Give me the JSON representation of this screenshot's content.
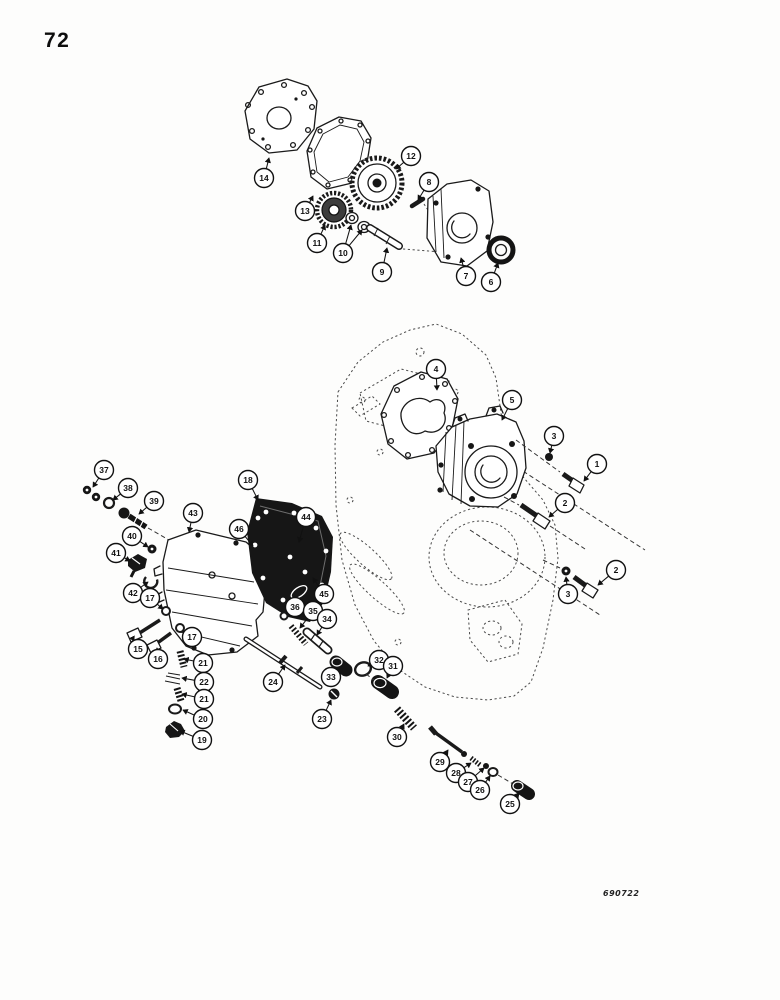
{
  "page": {
    "number": "72",
    "figure_code": "690722"
  },
  "diagram": {
    "description": "Exploded parts diagram: charging pump, transmission case and control valve assembly",
    "callouts": [
      {
        "label": "14",
        "cx": 264,
        "cy": 178,
        "tx": 269,
        "ty": 158
      },
      {
        "label": "13",
        "cx": 305,
        "cy": 211,
        "tx": 313,
        "ty": 196
      },
      {
        "label": "12",
        "cx": 411,
        "cy": 156,
        "tx": 396,
        "ty": 169
      },
      {
        "label": "11",
        "cx": 317,
        "cy": 243,
        "tx": 325,
        "ty": 225
      },
      {
        "label": "10",
        "cx": 343,
        "cy": 253,
        "tx": 351,
        "ty": 225,
        "tx2": 362,
        "ty2": 230
      },
      {
        "label": "9",
        "cx": 382,
        "cy": 272,
        "tx": 387,
        "ty": 248
      },
      {
        "label": "8",
        "cx": 429,
        "cy": 182,
        "tx": 418,
        "ty": 200
      },
      {
        "label": "7",
        "cx": 466,
        "cy": 276,
        "tx": 461,
        "ty": 258
      },
      {
        "label": "6",
        "cx": 491,
        "cy": 282,
        "tx": 498,
        "ty": 263
      },
      {
        "label": "4",
        "cx": 436,
        "cy": 369,
        "tx": 437,
        "ty": 390
      },
      {
        "label": "5",
        "cx": 512,
        "cy": 400,
        "tx": 502,
        "ty": 420
      },
      {
        "label": "3",
        "cx": 554,
        "cy": 436,
        "tx": 550,
        "ty": 453
      },
      {
        "label": "1",
        "cx": 597,
        "cy": 464,
        "tx": 584,
        "ty": 481
      },
      {
        "label": "2",
        "cx": 565,
        "cy": 503,
        "tx": 549,
        "ty": 517
      },
      {
        "label": "3",
        "cx": 568,
        "cy": 594,
        "tx": 566,
        "ty": 577
      },
      {
        "label": "2",
        "cx": 616,
        "cy": 570,
        "tx": 598,
        "ty": 585
      },
      {
        "label": "37",
        "cx": 104,
        "cy": 470,
        "tx": 93,
        "ty": 487
      },
      {
        "label": "38",
        "cx": 128,
        "cy": 488,
        "tx": 113,
        "ty": 500
      },
      {
        "label": "39",
        "cx": 154,
        "cy": 501,
        "tx": 139,
        "ty": 514
      },
      {
        "label": "43",
        "cx": 193,
        "cy": 513,
        "tx": 189,
        "ty": 532
      },
      {
        "label": "40",
        "cx": 132,
        "cy": 536,
        "tx": 148,
        "ty": 547
      },
      {
        "label": "41",
        "cx": 116,
        "cy": 553,
        "tx": 130,
        "ty": 561
      },
      {
        "label": "42",
        "cx": 133,
        "cy": 593,
        "tx": 148,
        "ty": 582
      },
      {
        "label": "17",
        "cx": 150,
        "cy": 598,
        "tx": 163,
        "ty": 609
      },
      {
        "label": "15",
        "cx": 138,
        "cy": 649,
        "tx": 134,
        "ty": 641
      },
      {
        "label": "16",
        "cx": 158,
        "cy": 659,
        "tx": 157,
        "ty": 648
      },
      {
        "label": "17",
        "cx": 192,
        "cy": 637,
        "tx": 183,
        "ty": 631
      },
      {
        "label": "21",
        "cx": 203,
        "cy": 663,
        "tx": 184,
        "ty": 659
      },
      {
        "label": "22",
        "cx": 204,
        "cy": 682,
        "tx": 182,
        "ty": 678
      },
      {
        "label": "21",
        "cx": 204,
        "cy": 699,
        "tx": 182,
        "ty": 694
      },
      {
        "label": "20",
        "cx": 203,
        "cy": 719,
        "tx": 183,
        "ty": 710
      },
      {
        "label": "19",
        "cx": 202,
        "cy": 740,
        "tx": 180,
        "ty": 731
      },
      {
        "label": "18",
        "cx": 248,
        "cy": 480,
        "tx": 258,
        "ty": 500
      },
      {
        "label": "46",
        "cx": 239,
        "cy": 529,
        "tx": 253,
        "ty": 546
      },
      {
        "label": "44",
        "cx": 306,
        "cy": 517,
        "tx": 299,
        "ty": 542
      },
      {
        "label": "45",
        "cx": 324,
        "cy": 594,
        "tx": 313,
        "ty": 578
      },
      {
        "label": "36",
        "cx": 295,
        "cy": 607,
        "tx": 286,
        "ty": 614
      },
      {
        "label": "35",
        "cx": 313,
        "cy": 611,
        "tx": 300,
        "ty": 628
      },
      {
        "label": "34",
        "cx": 327,
        "cy": 619,
        "tx": 317,
        "ty": 635
      },
      {
        "label": "24",
        "cx": 273,
        "cy": 682,
        "tx": 285,
        "ty": 665
      },
      {
        "label": "33",
        "cx": 331,
        "cy": 677,
        "tx": 338,
        "ty": 669
      },
      {
        "label": "23",
        "cx": 322,
        "cy": 719,
        "tx": 331,
        "ty": 700
      },
      {
        "label": "32",
        "cx": 379,
        "cy": 660,
        "tx": 368,
        "ty": 666
      },
      {
        "label": "31",
        "cx": 393,
        "cy": 666,
        "tx": 387,
        "ty": 678
      },
      {
        "label": "30",
        "cx": 397,
        "cy": 737,
        "tx": 404,
        "ty": 724
      },
      {
        "label": "29",
        "cx": 440,
        "cy": 762,
        "tx": 448,
        "ty": 750
      },
      {
        "label": "28",
        "cx": 456,
        "cy": 773,
        "tx": 471,
        "ty": 763
      },
      {
        "label": "27",
        "cx": 468,
        "cy": 782,
        "tx": 484,
        "ty": 768
      },
      {
        "label": "26",
        "cx": 480,
        "cy": 790,
        "tx": 490,
        "ty": 776
      },
      {
        "label": "25",
        "cx": 510,
        "cy": 804,
        "tx": 519,
        "ty": 793
      }
    ]
  }
}
